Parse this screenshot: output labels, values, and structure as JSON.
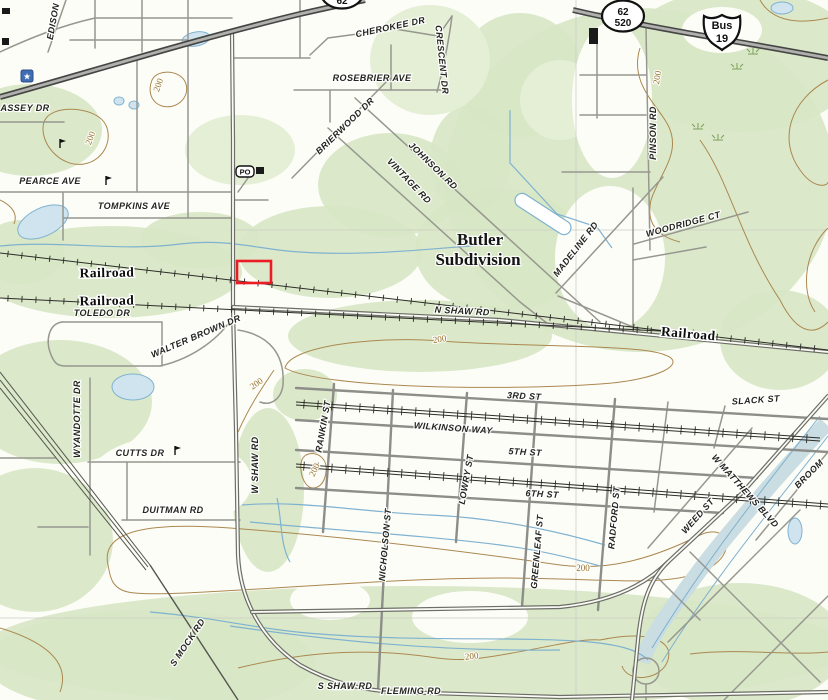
{
  "map_title": "Topographic map - Butler Subdivision area",
  "colors": {
    "background": "#fdfdf8",
    "forest_green": "#d7e7c4",
    "forest_green_light": "#e4efd6",
    "contour_brown": "#ab8850",
    "water_blue": "#7fb2d0",
    "pond_fill": "#cfe4ef",
    "canal_fill": "#c9dde2",
    "road_gray": "#8d8d89",
    "highway_dark": "#454545",
    "marker_red": "#ec1c24",
    "school_star_blue": "#3f6db3",
    "marsh_green": "#7da05a"
  },
  "marker": {
    "x": 237,
    "y": 261,
    "w": 34,
    "h": 22
  },
  "shields": {
    "main": {
      "type": "oval",
      "x": 623,
      "y": 16,
      "line1": "62",
      "line2": "520"
    },
    "bus": {
      "type": "us-shield",
      "x": 722,
      "y": 31,
      "line1": "Bus",
      "line2": "19"
    },
    "partial": {
      "type": "oval",
      "x": 342,
      "y": -7,
      "line1": "62",
      "line2": ""
    }
  },
  "poi": {
    "post_office_label": "PO",
    "post_office_x": 245,
    "post_office_y": 172
  },
  "street_labels": [
    {
      "text": "EDISON",
      "x": 56,
      "y": 22,
      "r": -80
    },
    {
      "text": "ASSEY DR",
      "x": 25,
      "y": 111,
      "r": 0
    },
    {
      "text": "PEARCE AVE",
      "x": 50,
      "y": 184,
      "r": 0
    },
    {
      "text": "TOMPKINS AVE",
      "x": 134,
      "y": 209,
      "r": 0
    },
    {
      "text": "CHEROKEE DR",
      "x": 391,
      "y": 30,
      "r": -12
    },
    {
      "text": "CRESCENT DR",
      "x": 439,
      "y": 60,
      "r": 84
    },
    {
      "text": "ROSEBRIER AVE",
      "x": 372,
      "y": 81,
      "r": 0
    },
    {
      "text": "BRIERWOOD DR",
      "x": 347,
      "y": 128,
      "r": -44
    },
    {
      "text": "JOHNSON RD",
      "x": 431,
      "y": 168,
      "r": 44
    },
    {
      "text": "VINTAGE RD",
      "x": 407,
      "y": 183,
      "r": 46
    },
    {
      "text": "MADELINE RD",
      "x": 578,
      "y": 251,
      "r": -52
    },
    {
      "text": "WOODRIDGE CT",
      "x": 684,
      "y": 227,
      "r": -15
    },
    {
      "text": "PINSON RD",
      "x": 656,
      "y": 133,
      "r": -90
    },
    {
      "text": "N SHAW RD",
      "x": 462,
      "y": 314,
      "r": 3
    },
    {
      "text": "TOLEDO DR",
      "x": 102,
      "y": 316,
      "r": 0
    },
    {
      "text": "WALTER BROWN DR",
      "x": 197,
      "y": 339,
      "r": -23
    },
    {
      "text": "WYANDOTTE DR",
      "x": 80,
      "y": 419,
      "r": -90
    },
    {
      "text": "CUTTS DR",
      "x": 140,
      "y": 456,
      "r": 0
    },
    {
      "text": "DUITMAN RD",
      "x": 173,
      "y": 513,
      "r": 0
    },
    {
      "text": "W SHAW RD",
      "x": 258,
      "y": 465,
      "r": -90
    },
    {
      "text": "RANKIN ST",
      "x": 326,
      "y": 427,
      "r": -80
    },
    {
      "text": "3RD ST",
      "x": 524,
      "y": 399,
      "r": 3
    },
    {
      "text": "WILKINSON WAY",
      "x": 453,
      "y": 431,
      "r": 4
    },
    {
      "text": "5TH ST",
      "x": 525,
      "y": 455,
      "r": 3
    },
    {
      "text": "LOWRY ST",
      "x": 469,
      "y": 480,
      "r": -80
    },
    {
      "text": "6TH ST",
      "x": 542,
      "y": 497,
      "r": 3
    },
    {
      "text": "NICHOLSON ST",
      "x": 388,
      "y": 545,
      "r": -85
    },
    {
      "text": "GREENLEAF ST",
      "x": 540,
      "y": 552,
      "r": -85
    },
    {
      "text": "RADFORD ST",
      "x": 617,
      "y": 518,
      "r": -85
    },
    {
      "text": "WEED ST",
      "x": 700,
      "y": 518,
      "r": -48
    },
    {
      "text": "SLACK ST",
      "x": 756,
      "y": 403,
      "r": -4
    },
    {
      "text": "W MATTHEWS BLVD",
      "x": 743,
      "y": 493,
      "r": 48
    },
    {
      "text": "BROOM",
      "x": 811,
      "y": 476,
      "r": -45
    },
    {
      "text": "S MOCK RD",
      "x": 190,
      "y": 644,
      "r": -56
    },
    {
      "text": "S SHAW RD",
      "x": 345,
      "y": 689,
      "r": 0
    },
    {
      "text": "FLEMING RD",
      "x": 411,
      "y": 694,
      "r": 0
    }
  ],
  "place_labels": [
    {
      "text": "Butler",
      "x": 480,
      "y": 245,
      "r": 0
    },
    {
      "text": "Subdivision",
      "x": 478,
      "y": 265,
      "r": 0
    }
  ],
  "railroad_labels": [
    {
      "text": "Railroad",
      "x": 107,
      "y": 277,
      "r": -1
    },
    {
      "text": "Railroad",
      "x": 107,
      "y": 305,
      "r": -1
    },
    {
      "text": "Railroad",
      "x": 688,
      "y": 338,
      "r": 5
    }
  ],
  "contour_labels": [
    {
      "text": "200",
      "x": 93,
      "y": 139,
      "r": -70
    },
    {
      "text": "200",
      "x": 161,
      "y": 86,
      "r": -70
    },
    {
      "text": "200",
      "x": 660,
      "y": 78,
      "r": -80
    },
    {
      "text": "200",
      "x": 440,
      "y": 342,
      "r": -8
    },
    {
      "text": "200",
      "x": 258,
      "y": 386,
      "r": -35
    },
    {
      "text": "200",
      "x": 317,
      "y": 471,
      "r": -65
    },
    {
      "text": "200",
      "x": 583,
      "y": 571,
      "r": 0
    },
    {
      "text": "200",
      "x": 472,
      "y": 659,
      "r": -6
    }
  ],
  "marsh_symbols": [
    [
      753,
      52
    ],
    [
      737,
      67
    ],
    [
      718,
      138
    ],
    [
      698,
      127
    ]
  ],
  "buildings": [
    [
      2,
      8,
      8,
      6
    ],
    [
      2,
      38,
      7,
      7
    ],
    [
      256,
      167,
      8,
      7
    ],
    [
      589,
      28,
      9,
      16
    ]
  ],
  "landmark_flags": [
    [
      106,
      176
    ],
    [
      60,
      139
    ],
    [
      175,
      446
    ]
  ],
  "school_star": {
    "x": 27,
    "y": 76
  }
}
